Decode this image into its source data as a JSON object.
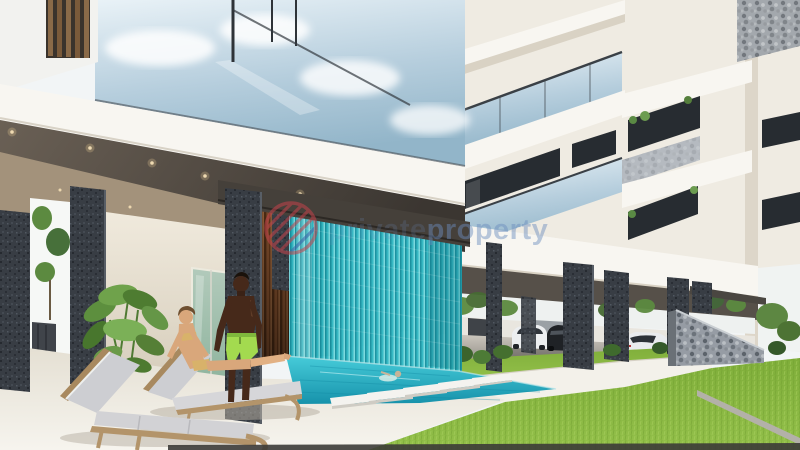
{
  "scene": {
    "type": "3d-architectural-render",
    "subject": "Modern multi-storey apartment building with ground-floor pool terrace, teal string water-feature curtain, sun loungers and covered parking",
    "people": [
      "woman in bikini reclining on wooden sun lounger",
      "man standing in lime swim shorts",
      "swimmer in pool"
    ],
    "pool": {
      "stepping_stones": 5,
      "water_feature": "teal hanging string curtain"
    },
    "vehicles": {
      "parked_cars": 3,
      "car_colors": [
        "white",
        "black",
        "white sports car"
      ]
    },
    "landscape": [
      "bright lawn",
      "gabion stone wall",
      "potted plant",
      "hedge bushes",
      "trees"
    ]
  },
  "watermark": {
    "brand_part1": "private",
    "brand_part2": "property",
    "logo": "striped-circle"
  },
  "palette": {
    "sky": "#f2f5f6",
    "facade": "#efebe2",
    "facade_bright": "#f8f6f1",
    "facade_shade": "#d9d2c4",
    "glass_light": "#e9f2f7",
    "glass_mid": "#b6cedd",
    "glass_deep": "#92b5c9",
    "ceiling_light": "#6a6055",
    "ceiling_dark": "#3b3631",
    "ceiling_tan": "#a3927b",
    "beam": "#45403a",
    "column": "#383d44",
    "wood": "#7a4a2a",
    "curtain": "#31b7c2",
    "curtain_dark": "#17909f",
    "curtain_light": "#78d8dd",
    "pool_top": "#47ccd9",
    "pool_deep": "#1792ab",
    "deck_top": "#e4dfd2",
    "deck_bottom": "#f6f4ee",
    "path": "#f3f1ea",
    "path_edge": "#d5d0c4",
    "grass_top": "#93c04a",
    "grass_bottom": "#7fae3a",
    "grass_mark": "#6e9c2e",
    "bush": "#43702f",
    "tree": "#5c8a40",
    "gabion": "#969ca4",
    "wall_cream": "#efe9dc",
    "door_glass": "#8fb49e",
    "wall_bg": "#e9e6df",
    "sky_strip": "#eef1f0",
    "skin_woman": "#d9a77b",
    "skin_man": "#46291a",
    "shorts": "#a3da4f",
    "bikini": "#d8b26a",
    "cushion": "#cdced2",
    "lounger_wood": "#b3946a",
    "car_white": "#eceef0",
    "car_black": "#1f2226",
    "car_sport": "#e9ebee",
    "window_dark": "#272c31",
    "wm_blue": "#6b8cbc",
    "wm_red": "#c4434c",
    "wm_navy": "#3e5fa8",
    "bottom_bar": "#3c3b37"
  }
}
